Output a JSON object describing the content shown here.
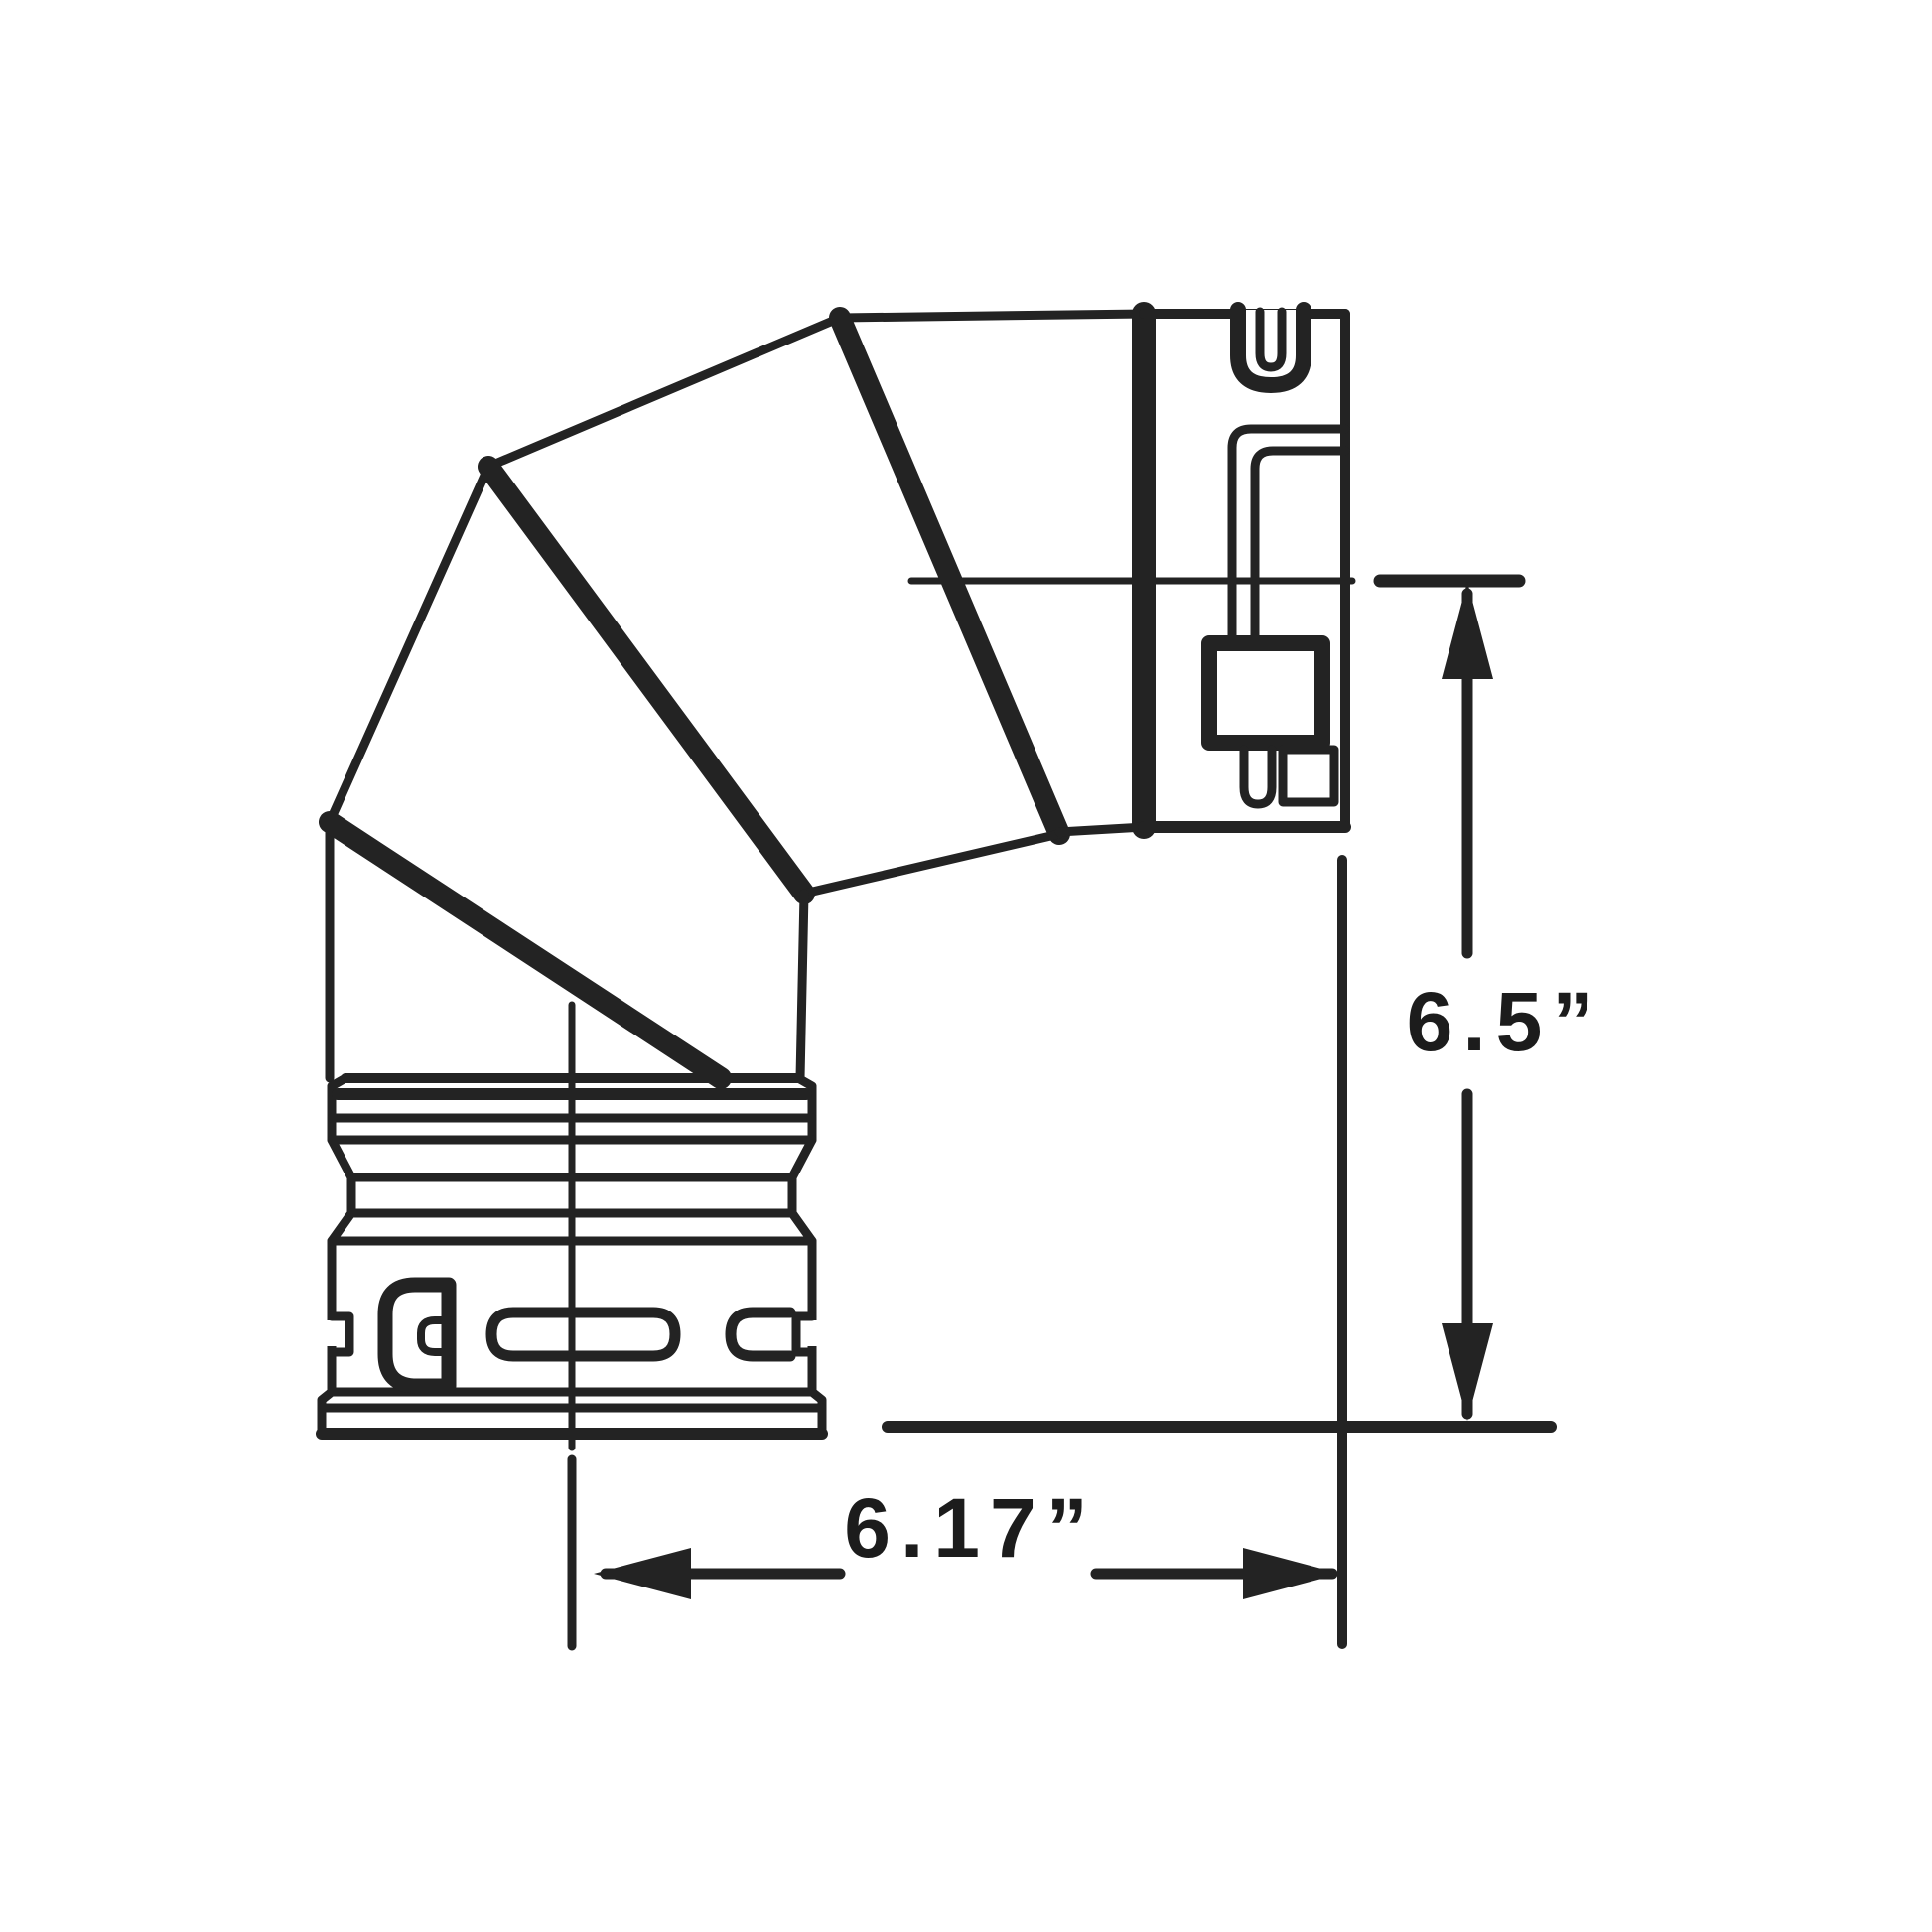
{
  "figure": {
    "type": "technical-line-drawing",
    "subject": "segmented 90-degree elbow pipe fitting, side view",
    "background_color": "#ffffff",
    "line_color": "#232323"
  },
  "dimensions": {
    "vertical": {
      "label": "6.5”",
      "value": 6.5,
      "unit": "inches",
      "orientation": "vertical"
    },
    "horizontal": {
      "label": "6.17”",
      "value": 6.17,
      "unit": "inches",
      "orientation": "horizontal"
    }
  }
}
